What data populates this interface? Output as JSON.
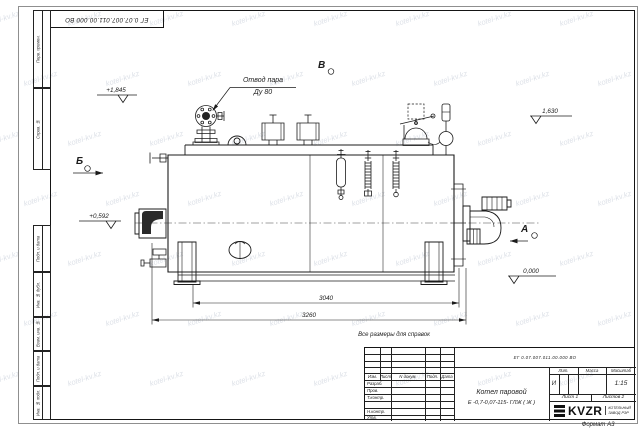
{
  "sheet": {
    "stamp_top": "ЕГ 0.07.007.011.00.000  ВО",
    "format_note": "Формат А3",
    "reference_note": "Все размеры для справок"
  },
  "side_columns": [
    {
      "label": "Перв. примен."
    },
    {
      "label": "Справ. №"
    },
    {
      "label": "Подп. и дата"
    },
    {
      "label": "Инв. № дубл."
    },
    {
      "label": "Взам. инв. №"
    },
    {
      "label": "Подп. и дата"
    },
    {
      "label": "Инв. № подл."
    }
  ],
  "annotations": {
    "steam_outlet_line1": "Отвод пара",
    "steam_outlet_line2": "Ду 80",
    "view_a": "А",
    "view_b": "Б",
    "view_v": "В",
    "elev_1845": "+1,845",
    "elev_1630": "1,630",
    "elev_0592": "+0,592",
    "elev_0000": "0,000",
    "dim_3040": "3040",
    "dim_3260": "3260"
  },
  "title_block": {
    "doc_number": "ЕГ 0.07.007.011.00.000  ВО",
    "product_name_line1": "Котел паровой",
    "product_name_line2": "Е -0,7-0,07-115- ГЛЖ ( Ж )",
    "col_izm": "Изм.",
    "col_list": "Лист",
    "col_doc": "N докум.",
    "col_podp": "Подп.",
    "col_data": "Дата",
    "row_razrab": "Разраб.",
    "row_prov": "Пров.",
    "row_tkontr": "Т.контр.",
    "row_nkontr": "Н.контр.",
    "row_utv": "Утв.",
    "lit_header": "Лит.",
    "mass_header": "Масса",
    "scale_header": "Масштаб",
    "lit_value": "И",
    "scale_value": "1:15",
    "sheet_label": "Лист 1",
    "sheets_label": "Листов 2",
    "logo_text": "KVZR",
    "logo_sub1": "КОТЕЛЬНЫЙ",
    "logo_sub2": "ЗАВОД РЭР"
  },
  "watermark": {
    "text": "kotel-kv.kz"
  },
  "colors": {
    "line": "#1b1b1b",
    "watermark": "#828ea8",
    "sheet": "#ffffff"
  }
}
